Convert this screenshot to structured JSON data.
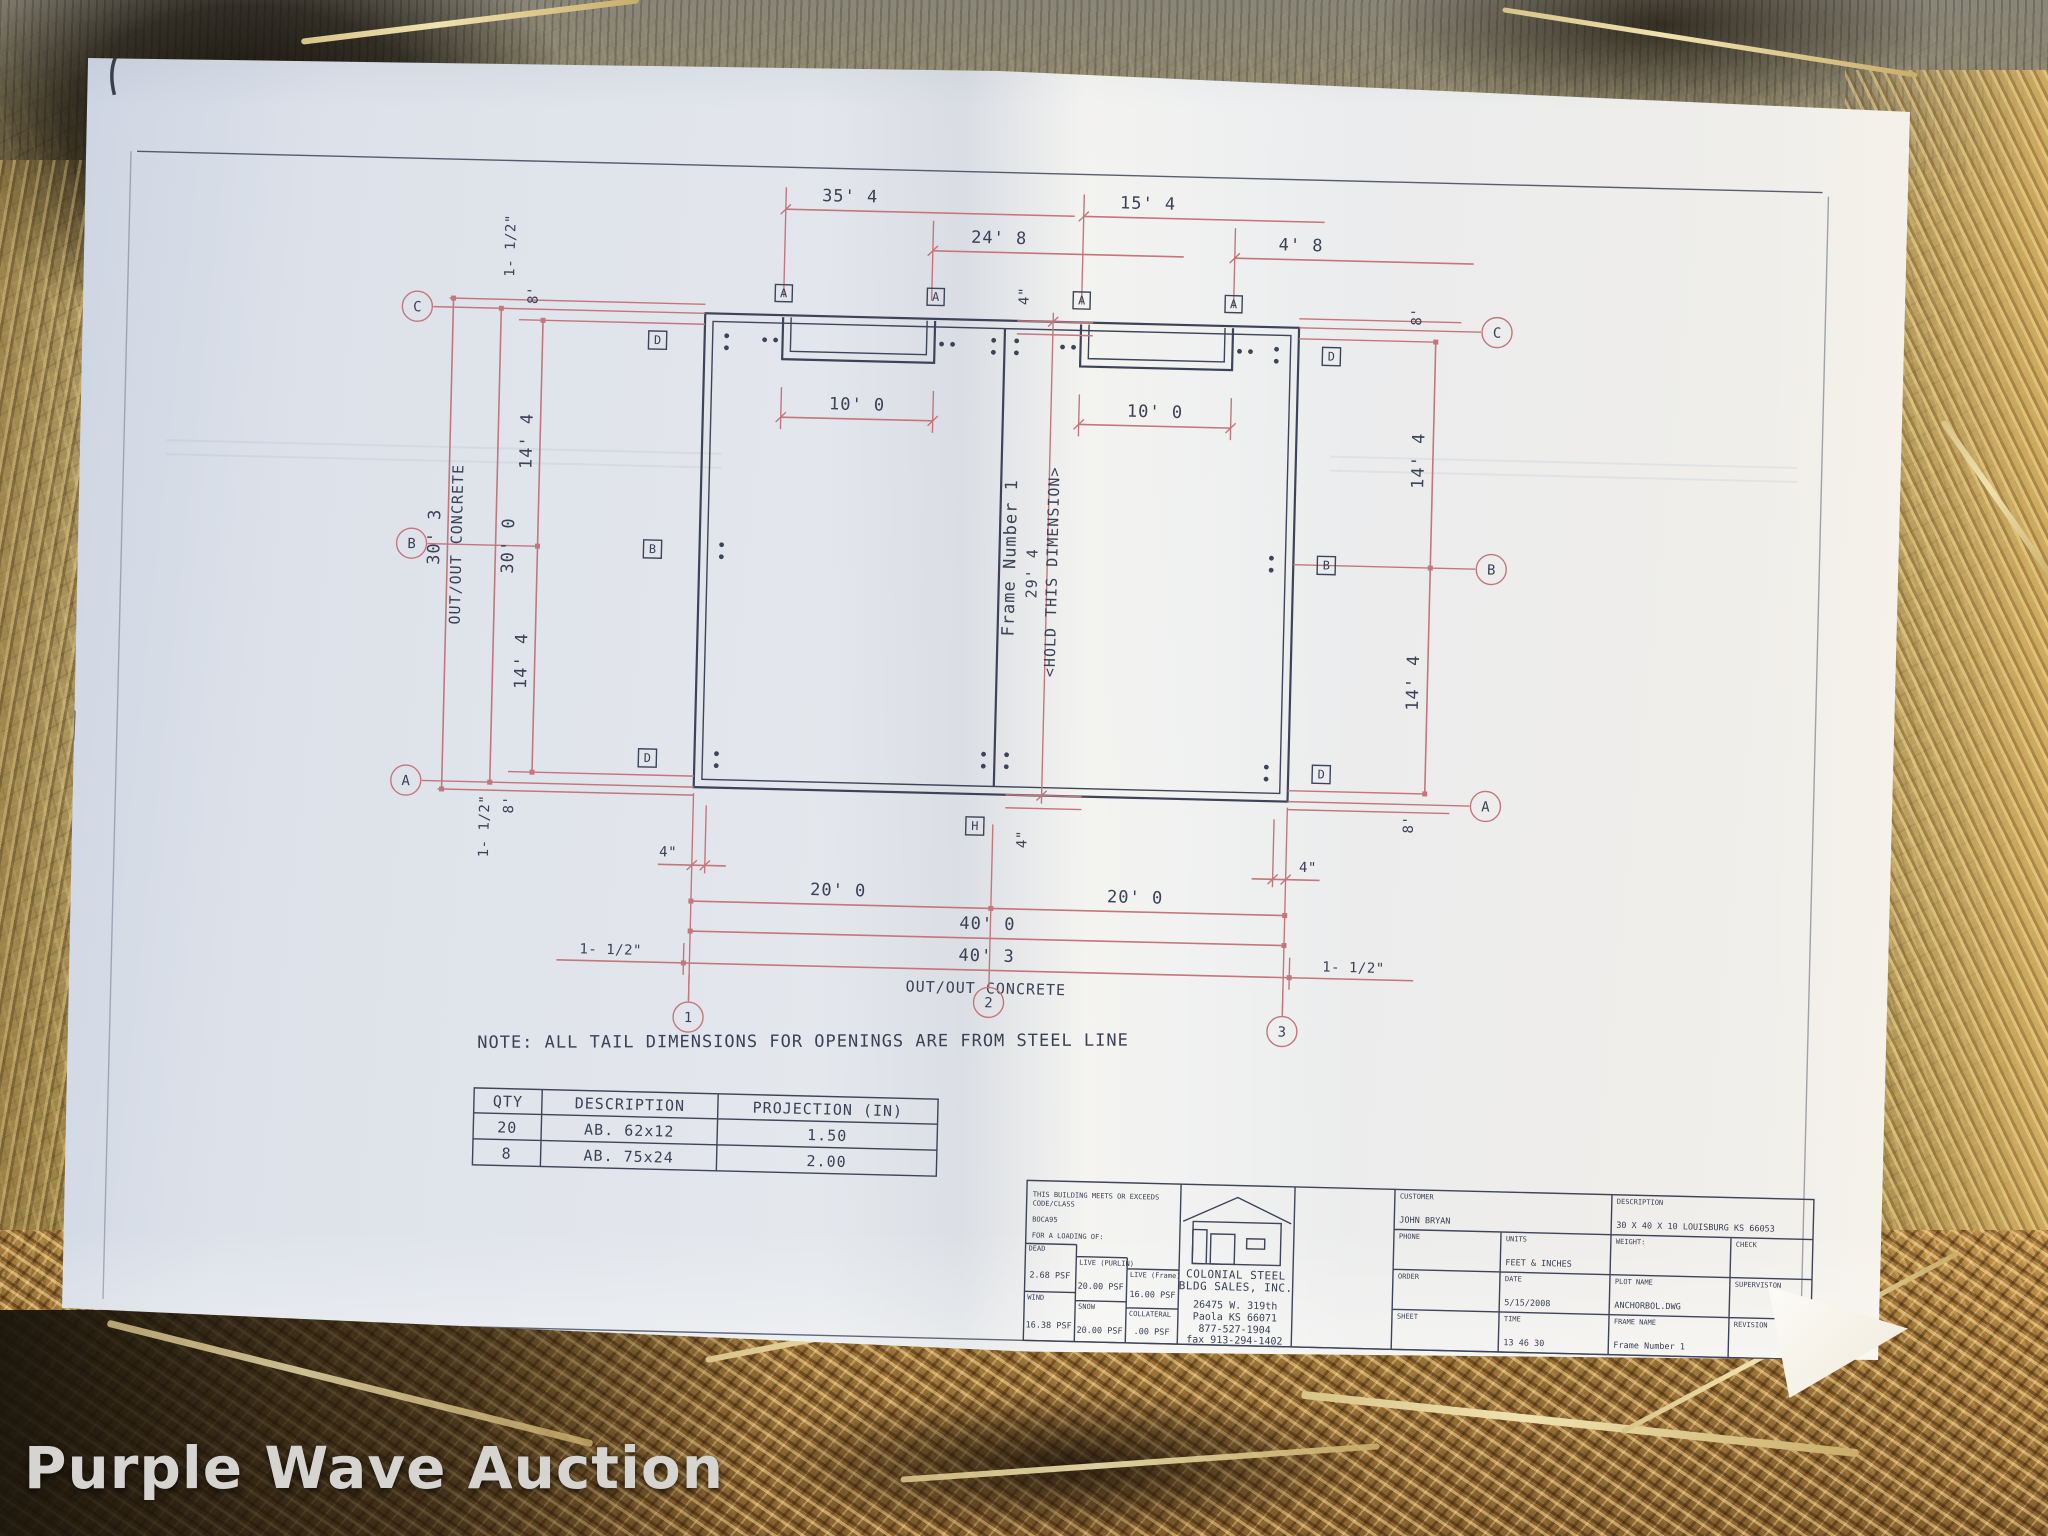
{
  "watermark": "Purple Wave Auction",
  "note": "NOTE:  ALL TAIL DIMENSIONS FOR OPENINGS ARE FROM STEEL LINE",
  "dims": {
    "top": [
      "35' 4",
      "24' 8",
      "15' 4",
      "4' 8"
    ],
    "openings": [
      "10' 0",
      "10' 0"
    ],
    "frame_text": "Frame Number 1",
    "frame_dim": "29' 4",
    "hold_text": "<HOLD THIS DIMENSION>",
    "offset_top": "4\"",
    "offset_bottom": "4\"",
    "left": {
      "concrete": "30' 3",
      "concrete_label": "OUT/OUT CONCRETE",
      "steel": "30' 0",
      "bay1": "14' 4",
      "bay2": "14' 4",
      "end_top": "8'",
      "end_bottom": "8'",
      "edge_top": "1- 1/2\"",
      "edge_bottom": "1- 1/2\""
    },
    "right": {
      "end_top": "8'",
      "bay1": "14' 4",
      "bay2": "14' 4",
      "end_bottom": "8'"
    },
    "bottom": {
      "off_left": "4\"",
      "off_right": "4\"",
      "bay1": "20' 0",
      "bay2": "20' 0",
      "steel": "40' 0",
      "concrete": "40' 3",
      "concrete_label": "OUT/OUT CONCRETE",
      "edge_left": "1- 1/2\"",
      "edge_right": "1- 1/2\""
    }
  },
  "grid": {
    "left": [
      "C",
      "B",
      "A"
    ],
    "right": [
      "C",
      "B",
      "A"
    ],
    "cols": [
      "1",
      "2",
      "3"
    ],
    "top_squares": [
      "A",
      "A",
      "A",
      "A"
    ],
    "left_squares": [
      "D",
      "B",
      "D"
    ],
    "right_squares": [
      "D",
      "B",
      "D"
    ],
    "bottom_square": "H"
  },
  "ab_table": {
    "headers": [
      "QTY",
      "DESCRIPTION",
      "PROJECTION (IN)"
    ],
    "rows": [
      [
        "20",
        "AB. 62x12",
        "1.50"
      ],
      [
        "8",
        "AB. 75x24",
        "2.00"
      ]
    ]
  },
  "title_block": {
    "meets1": "THIS BUILDING MEETS OR EXCEEDS",
    "meets2": "CODE/CLASS",
    "code": "BOCA95",
    "loading": "FOR A LOADING OF:",
    "loads": [
      {
        "label": "DEAD",
        "value": "2.68 PSF"
      },
      {
        "label": "LIVE (PURLIN)",
        "value": "20.00 PSF"
      },
      {
        "label": "LIVE (Frame)",
        "value": "16.00 PSF"
      },
      {
        "label": "WIND",
        "value": "16.38 PSF"
      },
      {
        "label": "SNOW",
        "value": "20.00 PSF"
      },
      {
        "label": "COLLATERAL",
        "value": ".00 PSF"
      }
    ],
    "company_line1": "COLONIAL STEEL",
    "company_line2": "BLDG SALES, INC.",
    "address1": "26475 W. 319th",
    "address2": "Paola KS 66071",
    "phone": "877-527-1904",
    "fax": "fax 913-294-1402",
    "customer_label": "CUSTOMER",
    "customer": "JOHN BRYAN",
    "phone_label": "PHONE",
    "units_label": "UNITS",
    "units": "FEET & INCHES",
    "description_label": "DESCRIPTION",
    "description": "30 X 40 X 10 LOUISBURG KS  66053",
    "weight_label": "WEIGHT:",
    "check_label": "CHECK",
    "order_label": "ORDER",
    "date_label": "DATE",
    "date": "5/15/2008",
    "plot_label": "PLOT NAME",
    "plot": "ANCHORBOL.DWG",
    "supervision_label": "SUPERVISION",
    "sheet_label": "SHEET",
    "time_label": "TIME",
    "time": "13 46 30",
    "frame_label": "FRAME NAME",
    "frame": "Frame Number 1",
    "revision_label": "REVISION"
  }
}
